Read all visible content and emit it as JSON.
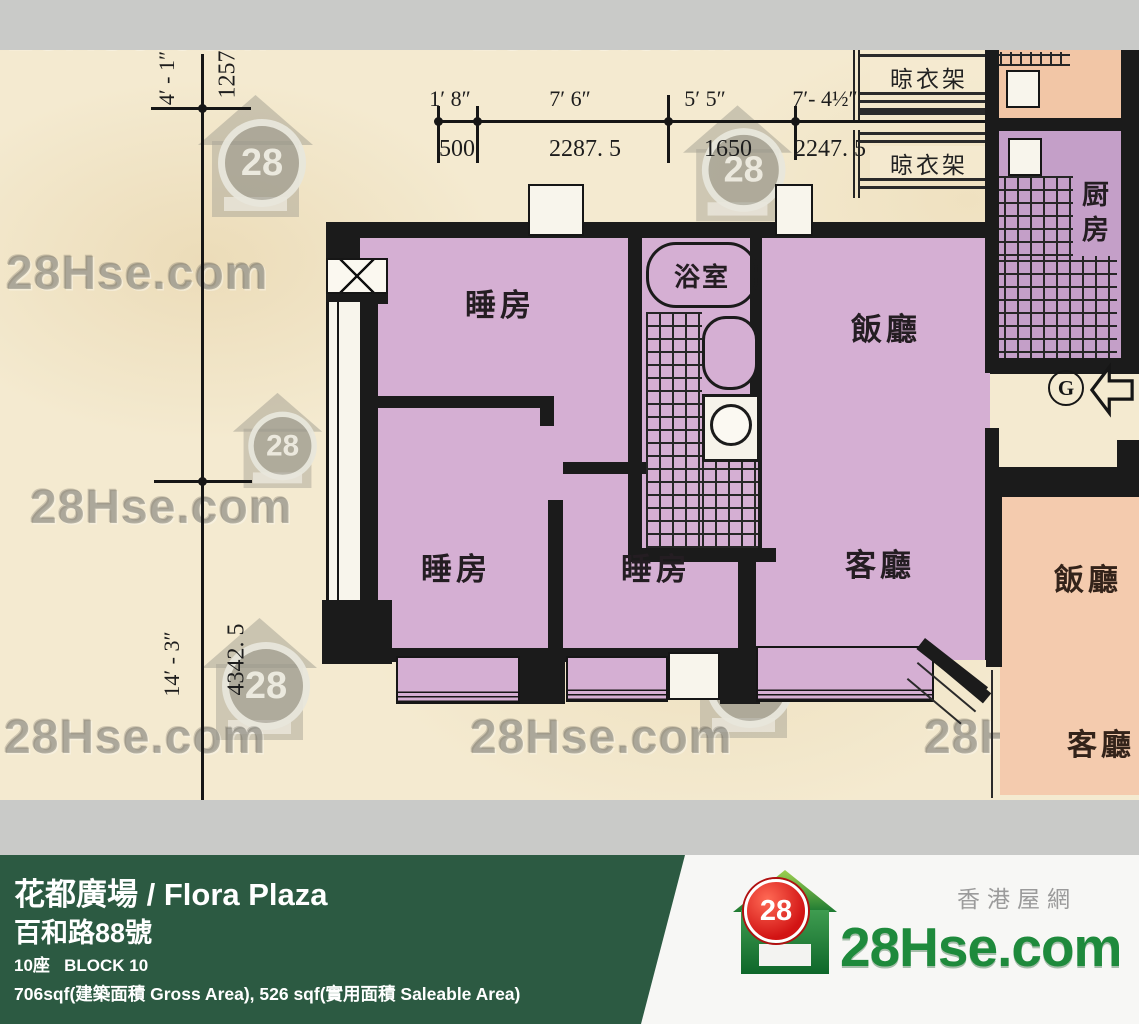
{
  "watermark": {
    "text": "28Hse.com",
    "logo_number": "28"
  },
  "plan": {
    "labels": {
      "bedroom": "睡房",
      "bathroom": "浴室",
      "dining": "飯廳",
      "living": "客廳",
      "kitchen": "厨房",
      "rack": "晾衣架",
      "entrance": "G"
    },
    "neighbor": {
      "dining": "飯廳",
      "living": "客廳"
    },
    "top_dim": {
      "feet": [
        "1′ 8″",
        "7′ 6″",
        "5′ 5″",
        "7′- 4½″"
      ],
      "mm": [
        "500",
        "2287. 5",
        "1650",
        "2247. 5"
      ]
    },
    "left_dim": {
      "upper_feet": "4′ - 1″",
      "upper_mm": "1257. 5",
      "lower_feet": "14′ - 3″",
      "lower_mm": "4342. 5"
    }
  },
  "banner": {
    "title": "花都廣場 / Flora Plaza",
    "address": "百和路88號",
    "block": "10座   BLOCK 10",
    "area": "706sqf(建築面積 Gross Area), 526 sqf(實用面積 Saleable Area)"
  },
  "brand": {
    "name": "28Hse.com",
    "tagline": "香港屋網",
    "logo_number": "28"
  }
}
